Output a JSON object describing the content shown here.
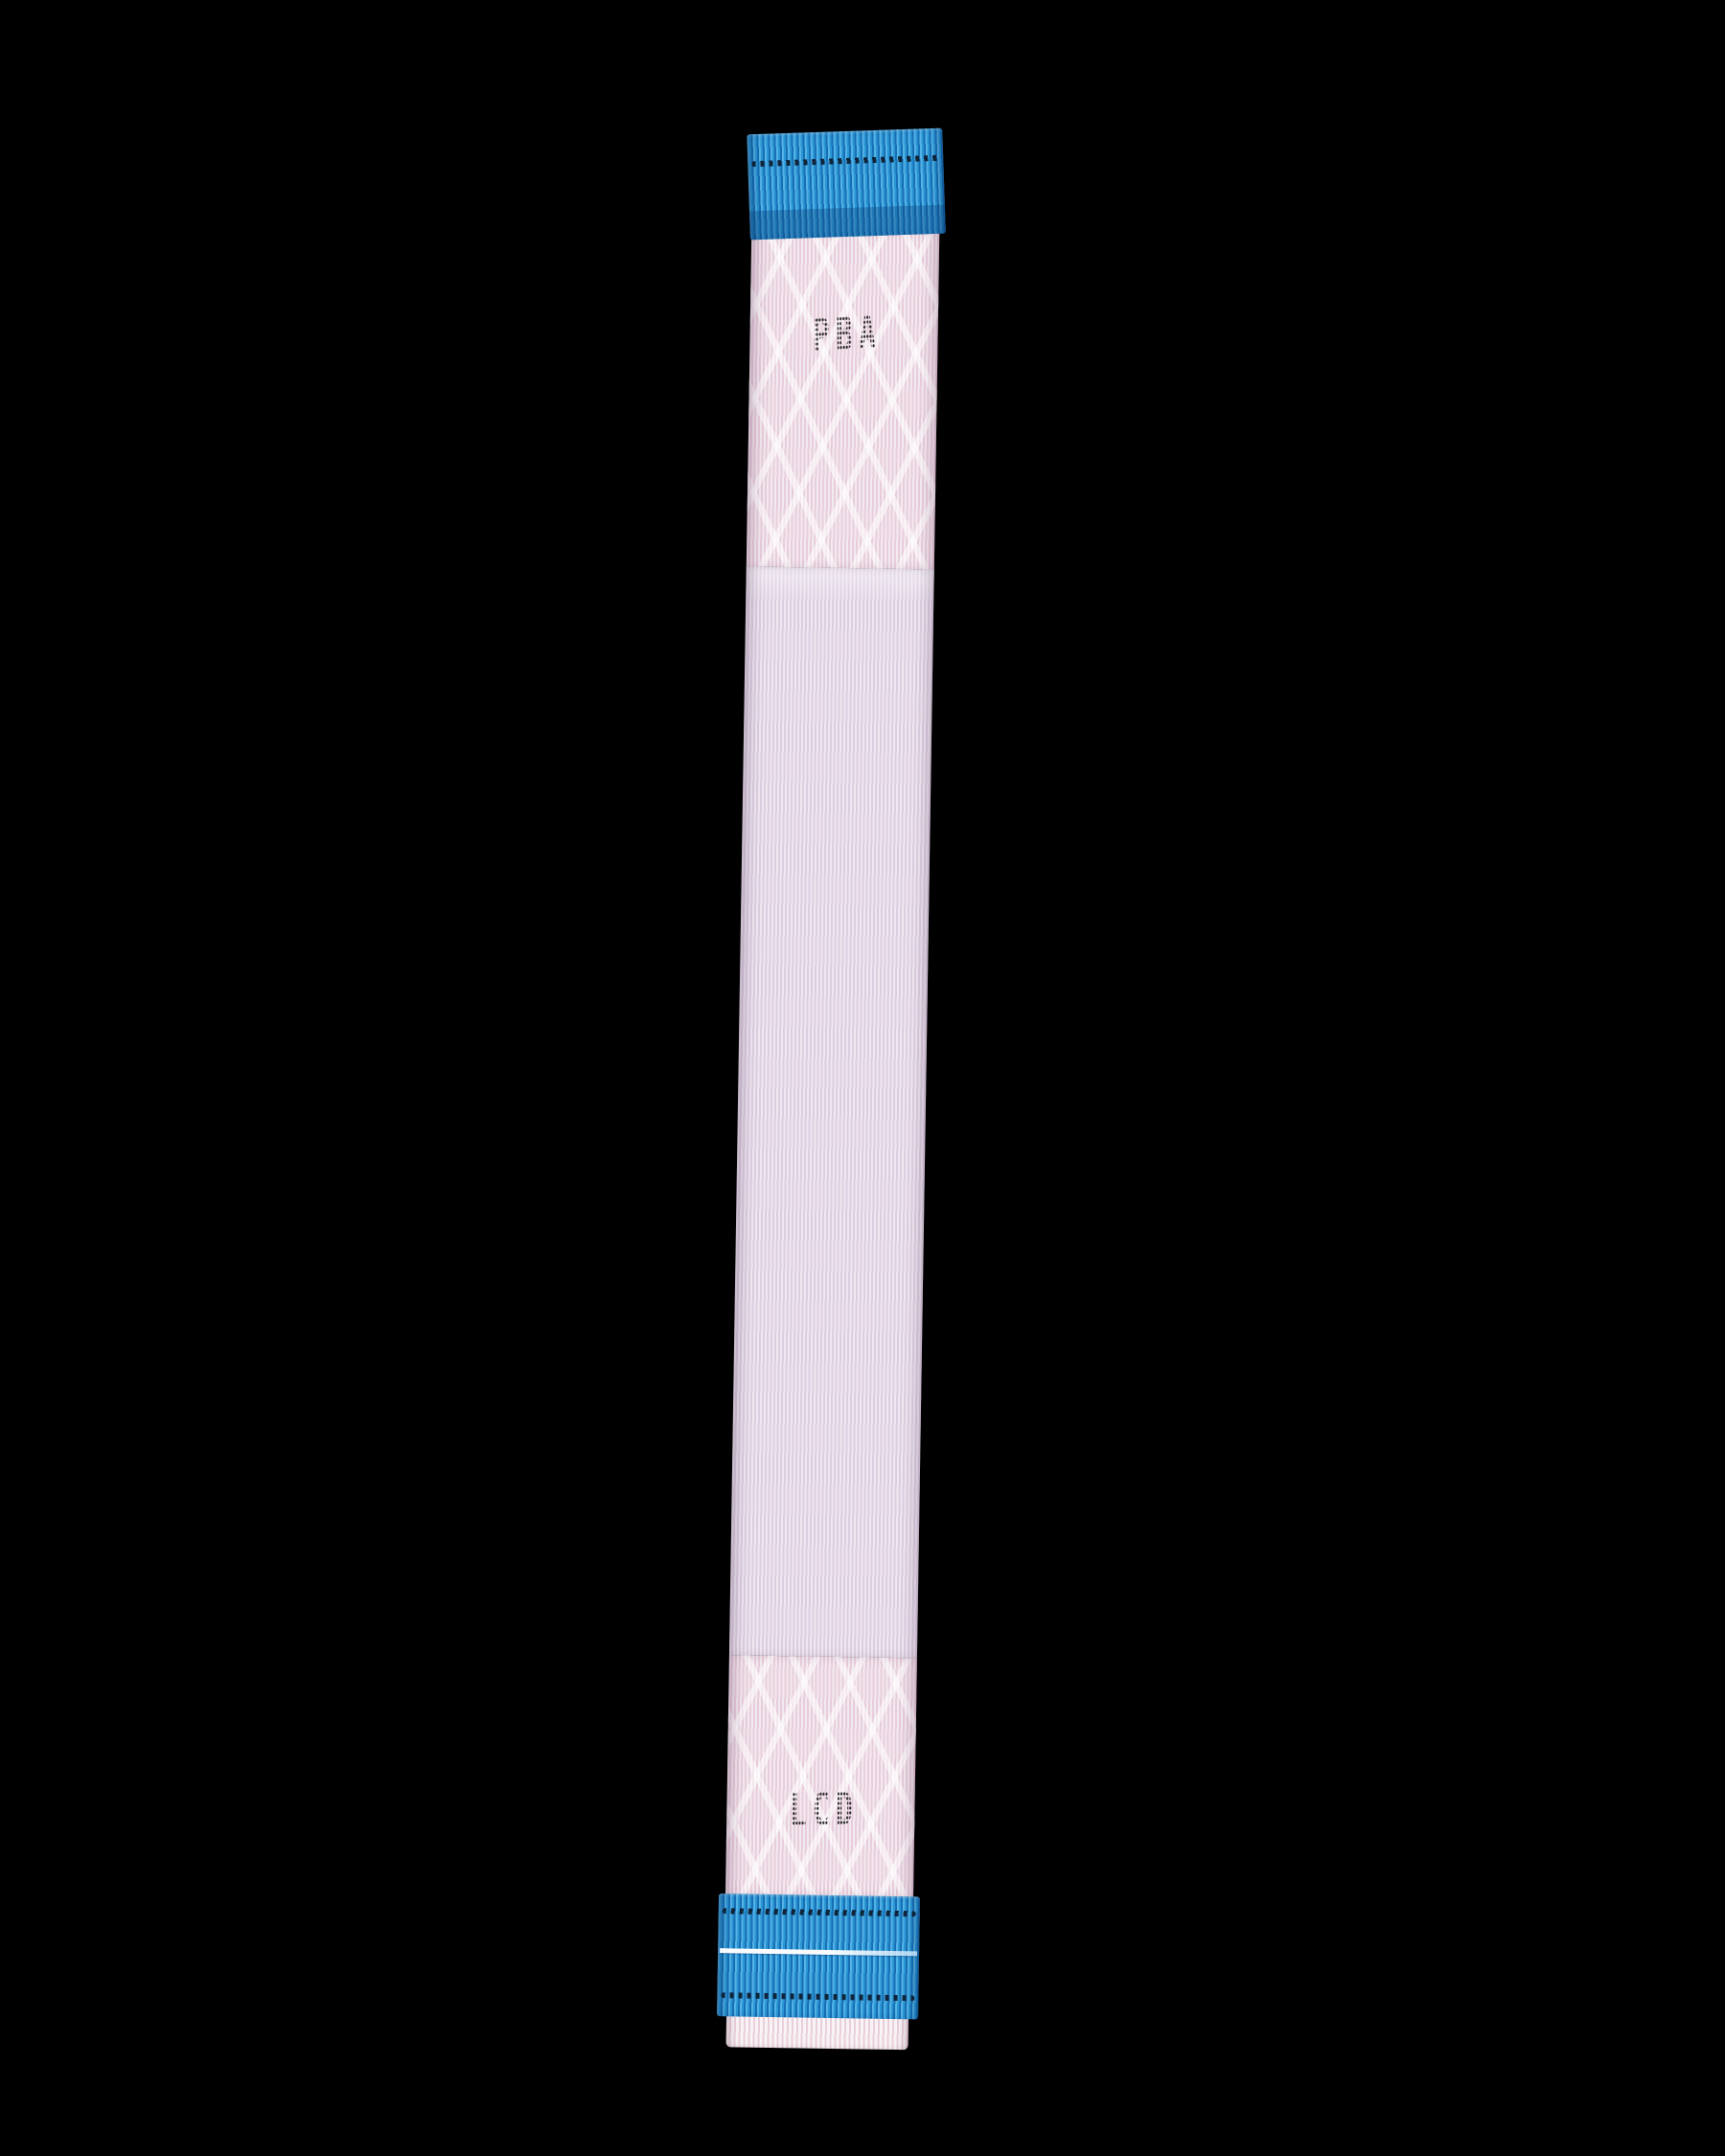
{
  "image": {
    "type": "product-photo",
    "subject": "LCD flex ribbon cable on black background"
  },
  "cable": {
    "top_label": "PBA",
    "bottom_label": "LCD",
    "colors": {
      "connector_blue_light": "#53b2e6",
      "connector_blue": "#2b96d4",
      "connector_blue_dark": "#176fb4",
      "ribbon_pink": "#e8cddc",
      "ribbon_white": "#f3eaef",
      "contact_dot_line": "#0c1a2c",
      "label_ink": "#18181a",
      "background": "#000000"
    }
  }
}
